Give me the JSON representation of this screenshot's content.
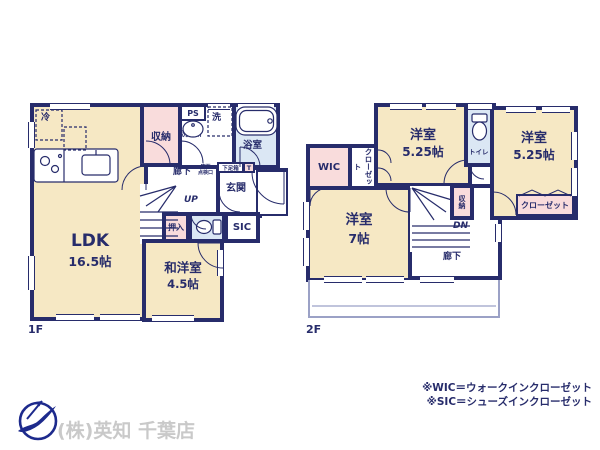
{
  "colors": {
    "wall": "#272c6b",
    "room_cream": "#f6e8c4",
    "room_pink": "#f9dcdc",
    "room_blue": "#dbe7f4",
    "balcony_line": "#9ba1c6",
    "company_text": "#c9c9c9",
    "logo_navy": "#1d2a8c"
  },
  "floor1": {
    "label": "1F",
    "ldk_name": "LDK",
    "ldk_size": "16.5帖",
    "waroom_name": "和洋室",
    "waroom_size": "4.5帖",
    "storage": "収納",
    "ps": "PS",
    "laundry": "洗",
    "washroom": "洗面所",
    "bath": "浴室",
    "hall": "廊下",
    "underfloor_line1": "床下",
    "underfloor_line2": "点検口",
    "shoebox": "下足箱",
    "t_mark": "T",
    "entrance": "玄関",
    "up": "UP",
    "oshiire": "押入",
    "sic": "SIC",
    "fridge": "冷"
  },
  "floor2": {
    "label": "2F",
    "room1_name": "洋室",
    "room1_size": "5.25帖",
    "room2_name": "洋室",
    "room2_size": "5.25帖",
    "room3_name": "洋室",
    "room3_size": "7帖",
    "toilet": "トイレ",
    "wic": "WIC",
    "closet_vertical": "クローゼット",
    "storage": "収納",
    "dn": "DN",
    "hall": "廊下",
    "closet": "クローゼット"
  },
  "notes": {
    "wic": "※WIC＝ウォークインクローゼット",
    "sic": "※SIC＝シューズインクローゼット"
  },
  "company": {
    "name": "(株)英知 千葉店"
  }
}
